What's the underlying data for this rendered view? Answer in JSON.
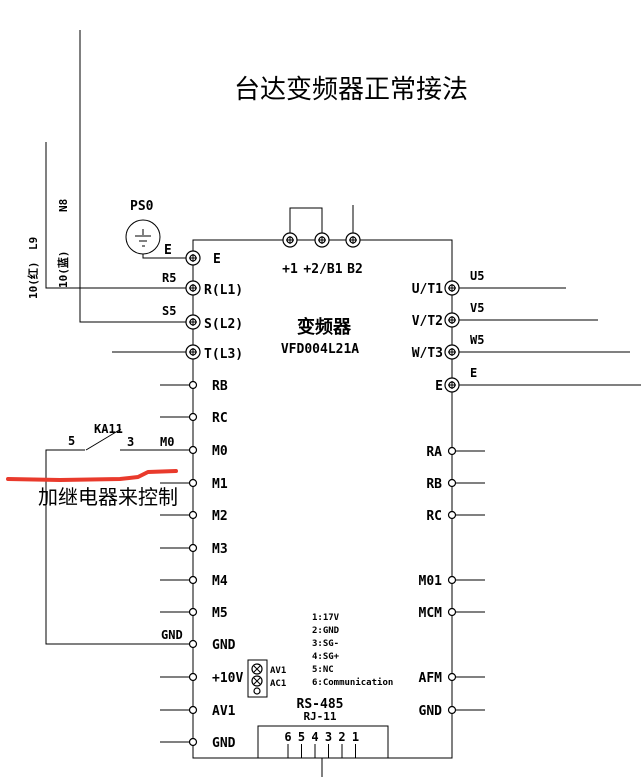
{
  "title": "台达变频器正常接法",
  "device": {
    "name": "变频器",
    "model": "VFD004L21A"
  },
  "colors": {
    "diagram_line": "#000000",
    "red_mark": "#e93a2c",
    "note_text": "#ef4fef"
  },
  "supply": {
    "line1_top": "L9",
    "line1_side": "10(红)",
    "line2_top": "N8",
    "line2_side": "10(蓝)",
    "wire_r": "R5",
    "wire_s": "S5",
    "wire_gnd": "GND"
  },
  "ground_source": {
    "label": "PS0",
    "terminal": "E"
  },
  "relay": {
    "name": "KA11",
    "left_pin": "5",
    "right_pin": "3",
    "wire": "M0",
    "note": "加继电器来控制"
  },
  "top_terminals": [
    "+1",
    "+2/B1",
    "B2"
  ],
  "left_terminals": [
    "E",
    "R(L1)",
    "S(L2)",
    "T(L3)",
    "RB",
    "RC",
    "M0",
    "M1",
    "M2",
    "M3",
    "M4",
    "M5",
    "GND",
    "+10V",
    "AV1",
    "GND"
  ],
  "right_power": [
    {
      "name": "U/T1",
      "wire": "U5"
    },
    {
      "name": "V/T2",
      "wire": "V5"
    },
    {
      "name": "W/T3",
      "wire": "W5"
    },
    {
      "name": "E",
      "wire": "E"
    }
  ],
  "right_terminals": [
    "RA",
    "RB",
    "RC",
    "M01",
    "MCM",
    "AFM",
    "GND"
  ],
  "analog_plug": {
    "pins": [
      "AV1",
      "AC1"
    ]
  },
  "rs485": {
    "pinout": [
      "1:17V",
      "2:GND",
      "3:SG-",
      "4:SG+",
      "5:NC",
      "6:Communication"
    ],
    "name": "RS-485",
    "connector": "RJ-11",
    "pins": [
      "6",
      "5",
      "4",
      "3",
      "2",
      "1"
    ]
  }
}
